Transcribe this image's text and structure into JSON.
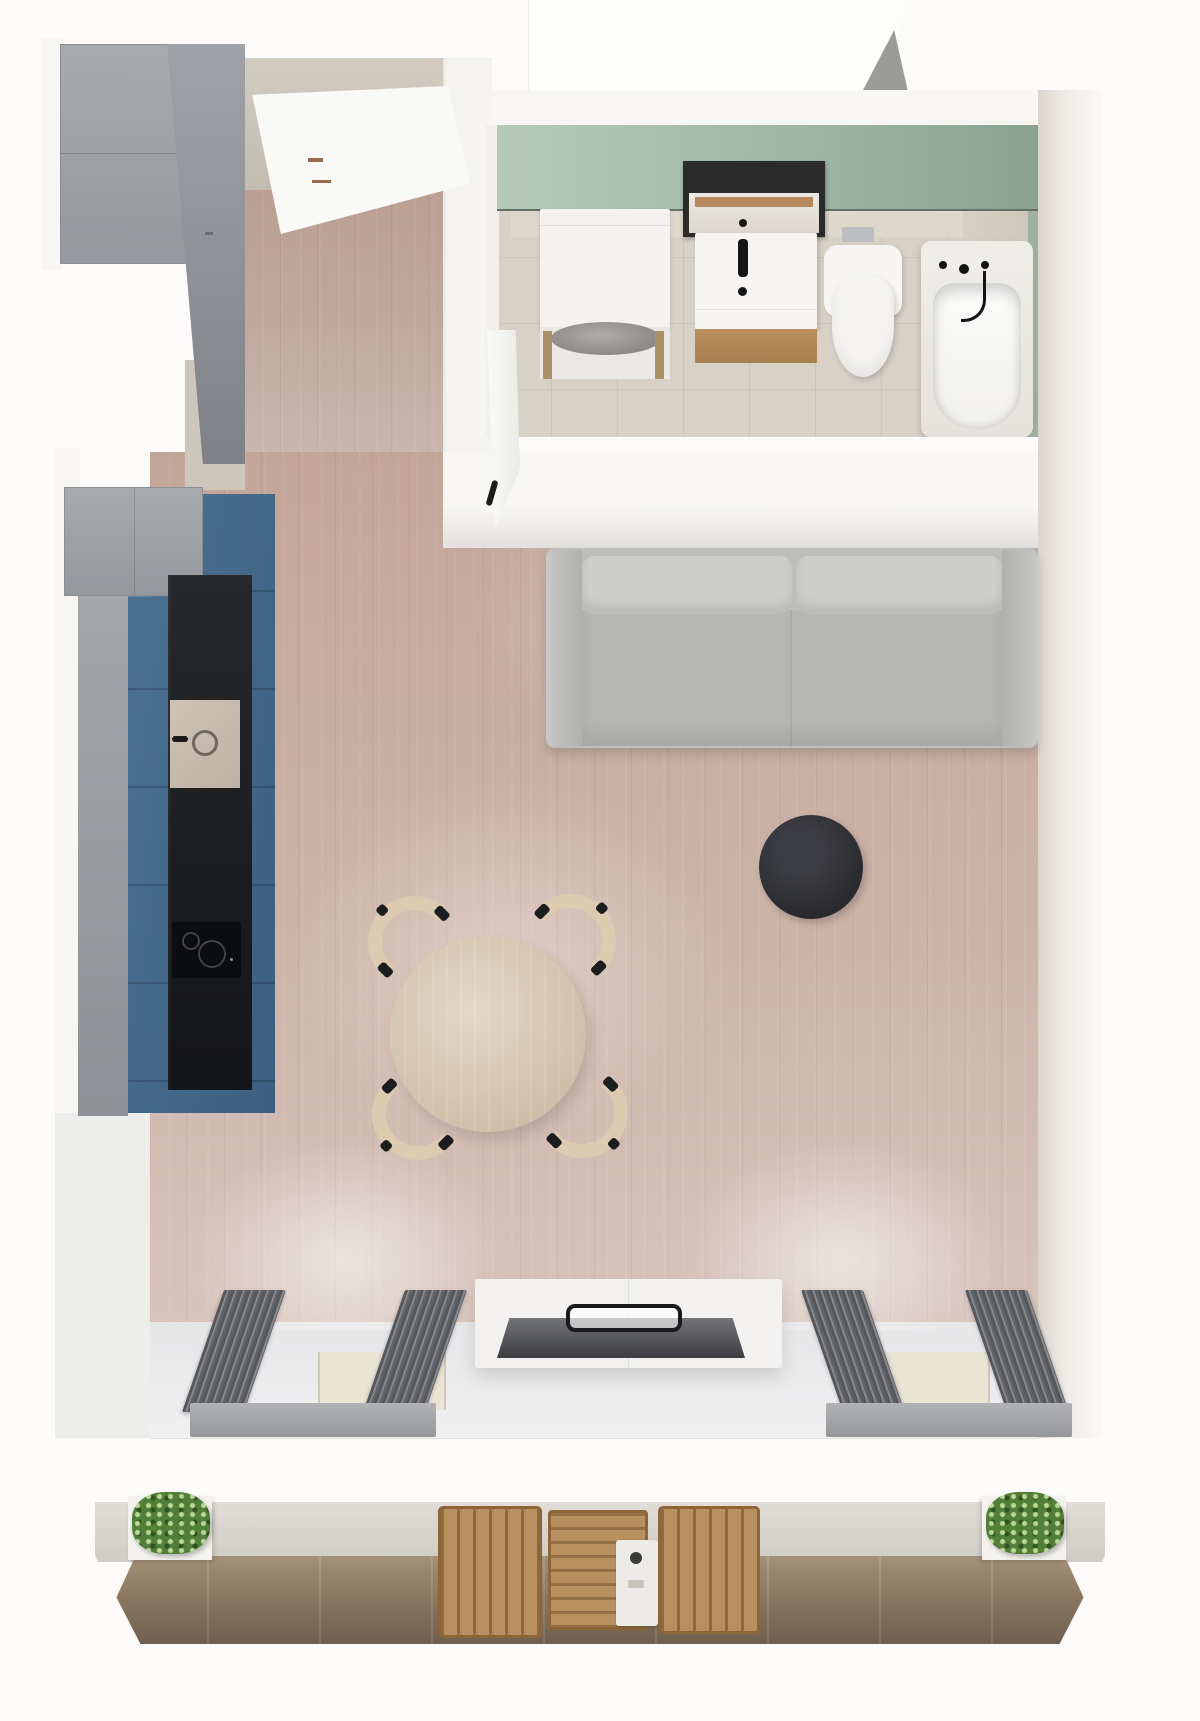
{
  "scene": {
    "title": "Studio apartment — top-down 3D floor plan render",
    "view": "top-down orthographic render, no visible text",
    "palette": {
      "page_background": "#fcfbf9",
      "wall_white": "#f7f6f3",
      "wood_floor": "#c6ab9f",
      "bathroom_wall_green": "#9fb6a4",
      "bathroom_floor_tile": "#d8d1c6",
      "kitchen_cabinet_gray": "#9b9ea2",
      "kitchen_front_blue": "#41678a",
      "kitchen_countertop_black": "#1e2023",
      "sofa_gray": "#bdbebc",
      "accent_round_table_black": "#2c2d31",
      "dining_wood": "#d5c5ae",
      "radiator_gray": "#606266",
      "balcony_wood": "#8a7861",
      "plant_green": "#527f38"
    },
    "rooms": [
      {
        "name": "entry-hallway",
        "items": [
          "entrance-door",
          "gray-wardrobe",
          "tall-gray-cabinet",
          "wood-floor"
        ]
      },
      {
        "name": "bathroom",
        "items": [
          "green-accent-wall",
          "washing-machine",
          "mirror",
          "vanity-sink-cabinet",
          "black-faucet",
          "wall-hung-toilet",
          "flush-plate",
          "bathtub",
          "bath-faucet",
          "open-bathroom-door",
          "beige-floor-tiles"
        ]
      },
      {
        "name": "kitchen",
        "items": [
          "gray-upper-cabinet",
          "blue-base-cabinets",
          "black-countertop",
          "sink-with-faucet",
          "induction-cooktop"
        ]
      },
      {
        "name": "living-room",
        "items": [
          "three-seat-sofa",
          "sofa-back-cushions-x2",
          "black-round-side-table",
          "round-dining-table",
          "dining-chairs-x4",
          "tv-stand",
          "tv-screen",
          "tv-mount",
          "radiators-x4",
          "window-sills-x2",
          "windows"
        ]
      },
      {
        "name": "balcony",
        "items": [
          "planter-left",
          "planter-right",
          "outdoor-chair-left",
          "outdoor-chair-right",
          "outdoor-slat-table",
          "white-tray",
          "dark-wood-deck"
        ]
      }
    ],
    "counts": {
      "sofa_back_cushions": 2,
      "dining_chairs": 4,
      "radiators": 4,
      "balcony_plants": 2,
      "outdoor_chairs": 2
    }
  }
}
